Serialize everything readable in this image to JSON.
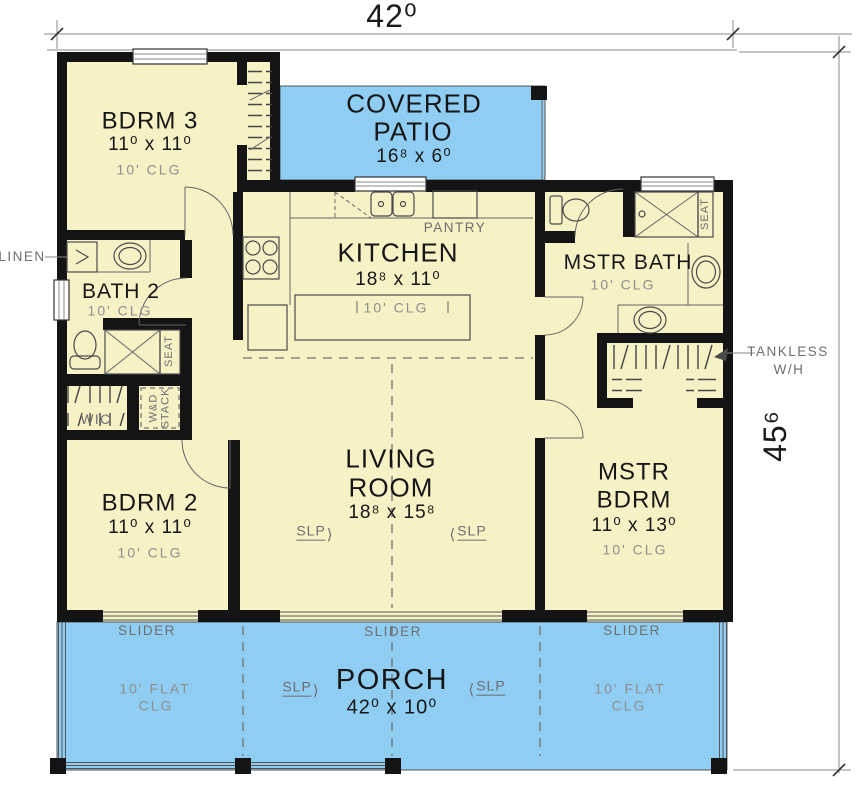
{
  "dimensions": {
    "width_label": "42⁰",
    "height_label": "45⁶"
  },
  "rooms": {
    "bdrm3": {
      "name": "BDRM 3",
      "size": "11⁰ x 11⁰",
      "clg": "10' CLG"
    },
    "covered_patio": {
      "name1": "COVERED",
      "name2": "PATIO",
      "size": "16⁸ x 6⁰"
    },
    "kitchen": {
      "name": "KITCHEN",
      "size": "18⁸ x 11⁰",
      "clg": "10' CLG"
    },
    "mstr_bath": {
      "name": "MSTR BATH",
      "clg": "10' CLG"
    },
    "bath2": {
      "name": "BATH 2",
      "clg": "10' CLG"
    },
    "living": {
      "name1": "LIVING",
      "name2": "ROOM",
      "size": "18⁸ x 15⁸"
    },
    "bdrm2": {
      "name": "BDRM 2",
      "size": "11⁰ x 11⁰",
      "clg": "10' CLG"
    },
    "mstr_bdrm": {
      "name1": "MSTR",
      "name2": "BDRM",
      "size": "11⁰ x 13⁰",
      "clg": "10' CLG"
    },
    "porch": {
      "name": "PORCH",
      "size": "42⁰ x 10⁰",
      "flat1": "10' FLAT",
      "flat2": "CLG"
    }
  },
  "labels": {
    "pantry": "PANTRY",
    "linen": "LINEN",
    "wic": "WIC",
    "wd1": "W&D",
    "wd2": "STACK",
    "seat": "SEAT",
    "slider": "SLIDER",
    "slp": "SLP",
    "arrow_right": "⟩",
    "arrow_left": "⟨",
    "tankless1": "TANKLESS",
    "tankless2": "W/H"
  },
  "colors": {
    "room_fill": "#f7f1c6",
    "outdoor_fill": "#8fcdf3",
    "wall": "#141414",
    "gray_text": "#6e6e6e",
    "light_gray_text": "#8f8f8f"
  }
}
